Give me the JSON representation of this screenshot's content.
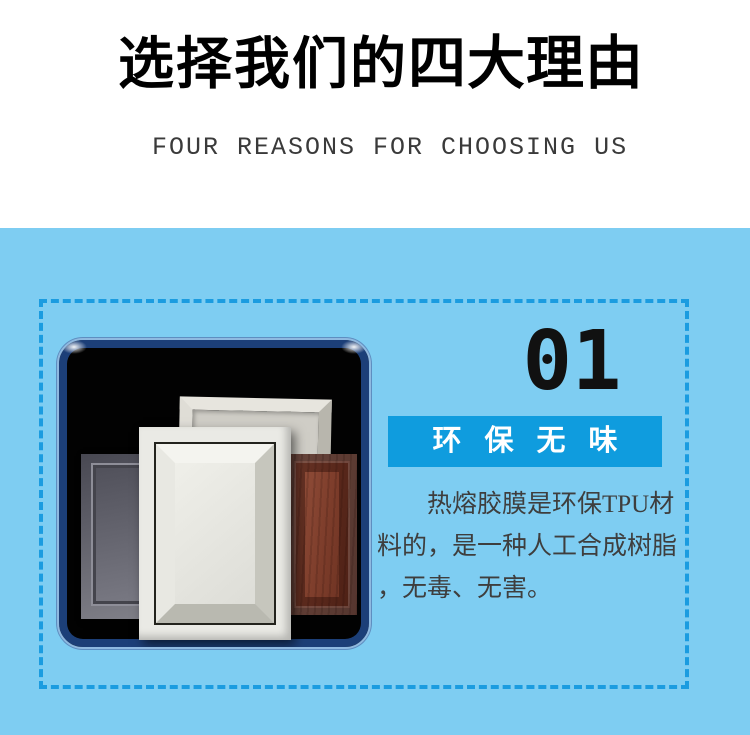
{
  "header": {
    "title_regular": "选择我们的",
    "title_bold": "四大理由",
    "subtitle": "FOUR REASONS FOR CHOOSING US"
  },
  "reason": {
    "number": "01",
    "badge": "环保无味",
    "body_lines": [
      "热熔胶膜是环保TPU材",
      "料的，是一种人工合成树脂",
      "，无毒、无害。"
    ]
  },
  "colors": {
    "section_bg": "#7ECDF2",
    "dashed_border": "#1B9CE0",
    "badge_bg": "#0F9CDE",
    "badge_text": "#FFFFFF",
    "body_text": "#3E3E3E",
    "title_text": "#000000",
    "number_text": "#111111"
  }
}
